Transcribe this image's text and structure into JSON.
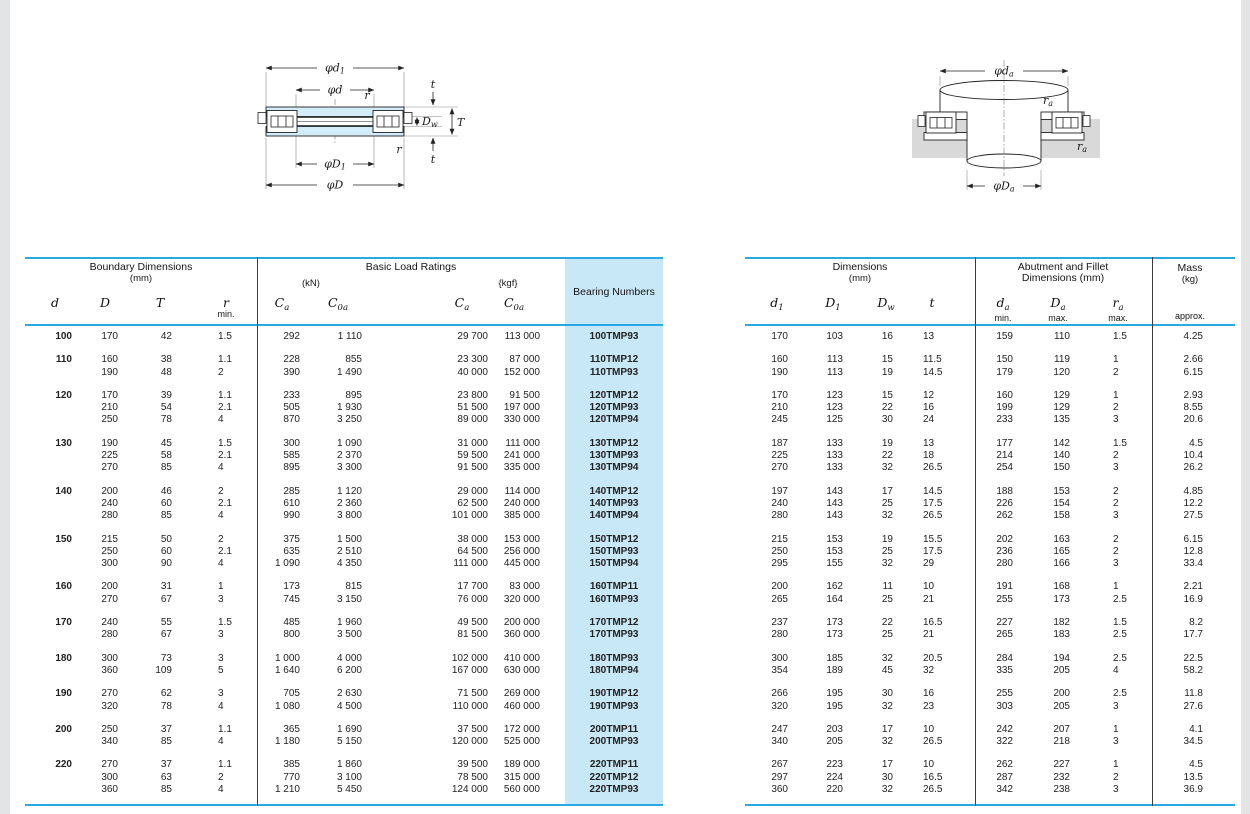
{
  "accent_colors": {
    "rule_cyan": "#29a9e1",
    "shade_blue": "#c9e8f7",
    "washer_blue": "#d3ecfa",
    "housing_gray": "#d9d9d9"
  },
  "diagram_left": {
    "labels": {
      "d1": {
        "main": "φd",
        "sub": "1"
      },
      "d": {
        "main": "φd",
        "sub": ""
      },
      "r_top": {
        "main": "r",
        "sub": ""
      },
      "t_top": {
        "main": "t",
        "sub": ""
      },
      "Dw": {
        "main": "D",
        "sub": "w"
      },
      "T": {
        "main": "T",
        "sub": ""
      },
      "r_bot": {
        "main": "r",
        "sub": ""
      },
      "t_bot": {
        "main": "t",
        "sub": ""
      },
      "D1": {
        "main": "φD",
        "sub": "1"
      },
      "D": {
        "main": "φD",
        "sub": ""
      }
    }
  },
  "diagram_right": {
    "labels": {
      "da": {
        "main": "φd",
        "sub": "a"
      },
      "ra_top": {
        "main": "r",
        "sub": "a"
      },
      "ra_bot": {
        "main": "r",
        "sub": "a"
      },
      "Da": {
        "main": "φD",
        "sub": "a"
      }
    }
  },
  "left_table": {
    "group_header": {
      "boundary": "Boundary Dimensions",
      "boundary_unit": "(mm)",
      "load": "Basic Load Ratings",
      "kn": "(kN)",
      "kgf": "{kgf}",
      "bearing": "Bearing Numbers"
    },
    "symbols": {
      "d": {
        "main": "d",
        "sub": ""
      },
      "D": {
        "main": "D",
        "sub": ""
      },
      "T": {
        "main": "T",
        "sub": ""
      },
      "r": {
        "main": "r",
        "sub": "",
        "note": "min."
      },
      "Ca_kn": {
        "main": "C",
        "sub": "a"
      },
      "C0a_kn": {
        "main": "C",
        "sub": "0a"
      },
      "Ca_kgf": {
        "main": "C",
        "sub": "a"
      },
      "C0a_kgf": {
        "main": "C",
        "sub": "0a"
      }
    },
    "groups": [
      [
        [
          "100",
          "170",
          "42",
          "1.5",
          "292",
          "1 110",
          "29 700",
          "113 000",
          "100TMP93"
        ]
      ],
      [
        [
          "110",
          "160",
          "38",
          "1.1",
          "228",
          "855",
          "23 300",
          "87 000",
          "110TMP12"
        ],
        [
          "",
          "190",
          "48",
          "2",
          "390",
          "1 490",
          "40 000",
          "152 000",
          "110TMP93"
        ]
      ],
      [
        [
          "120",
          "170",
          "39",
          "1.1",
          "233",
          "895",
          "23 800",
          "91 500",
          "120TMP12"
        ],
        [
          "",
          "210",
          "54",
          "2.1",
          "505",
          "1 930",
          "51 500",
          "197 000",
          "120TMP93"
        ],
        [
          "",
          "250",
          "78",
          "4",
          "870",
          "3 250",
          "89 000",
          "330 000",
          "120TMP94"
        ]
      ],
      [
        [
          "130",
          "190",
          "45",
          "1.5",
          "300",
          "1 090",
          "31 000",
          "111 000",
          "130TMP12"
        ],
        [
          "",
          "225",
          "58",
          "2.1",
          "585",
          "2 370",
          "59 500",
          "241 000",
          "130TMP93"
        ],
        [
          "",
          "270",
          "85",
          "4",
          "895",
          "3 300",
          "91 500",
          "335 000",
          "130TMP94"
        ]
      ],
      [
        [
          "140",
          "200",
          "46",
          "2",
          "285",
          "1 120",
          "29 000",
          "114 000",
          "140TMP12"
        ],
        [
          "",
          "240",
          "60",
          "2.1",
          "610",
          "2 360",
          "62 500",
          "240 000",
          "140TMP93"
        ],
        [
          "",
          "280",
          "85",
          "4",
          "990",
          "3 800",
          "101 000",
          "385 000",
          "140TMP94"
        ]
      ],
      [
        [
          "150",
          "215",
          "50",
          "2",
          "375",
          "1 500",
          "38 000",
          "153 000",
          "150TMP12"
        ],
        [
          "",
          "250",
          "60",
          "2.1",
          "635",
          "2 510",
          "64 500",
          "256 000",
          "150TMP93"
        ],
        [
          "",
          "300",
          "90",
          "4",
          "1 090",
          "4 350",
          "111 000",
          "445 000",
          "150TMP94"
        ]
      ],
      [
        [
          "160",
          "200",
          "31",
          "1",
          "173",
          "815",
          "17 700",
          "83 000",
          "160TMP11"
        ],
        [
          "",
          "270",
          "67",
          "3",
          "745",
          "3 150",
          "76 000",
          "320 000",
          "160TMP93"
        ]
      ],
      [
        [
          "170",
          "240",
          "55",
          "1.5",
          "485",
          "1 960",
          "49 500",
          "200 000",
          "170TMP12"
        ],
        [
          "",
          "280",
          "67",
          "3",
          "800",
          "3 500",
          "81 500",
          "360 000",
          "170TMP93"
        ]
      ],
      [
        [
          "180",
          "300",
          "73",
          "3",
          "1 000",
          "4 000",
          "102 000",
          "410 000",
          "180TMP93"
        ],
        [
          "",
          "360",
          "109",
          "5",
          "1 640",
          "6 200",
          "167 000",
          "630 000",
          "180TMP94"
        ]
      ],
      [
        [
          "190",
          "270",
          "62",
          "3",
          "705",
          "2 630",
          "71 500",
          "269 000",
          "190TMP12"
        ],
        [
          "",
          "320",
          "78",
          "4",
          "1 080",
          "4 500",
          "110 000",
          "460 000",
          "190TMP93"
        ]
      ],
      [
        [
          "200",
          "250",
          "37",
          "1.1",
          "365",
          "1 690",
          "37 500",
          "172 000",
          "200TMP11"
        ],
        [
          "",
          "340",
          "85",
          "4",
          "1 180",
          "5 150",
          "120 000",
          "525 000",
          "200TMP93"
        ]
      ],
      [
        [
          "220",
          "270",
          "37",
          "1.1",
          "385",
          "1 860",
          "39 500",
          "189 000",
          "220TMP11"
        ],
        [
          "",
          "300",
          "63",
          "2",
          "770",
          "3 100",
          "78 500",
          "315 000",
          "220TMP12"
        ],
        [
          "",
          "360",
          "85",
          "4",
          "1 210",
          "5 450",
          "124 000",
          "560 000",
          "220TMP93"
        ]
      ]
    ]
  },
  "right_table": {
    "group_header": {
      "dims": "Dimensions",
      "dims_unit": "(mm)",
      "abutment_line1": "Abutment and Fillet",
      "abutment_line2": "Dimensions (mm)",
      "mass": "Mass",
      "mass_unit": "(kg)",
      "approx": "approx."
    },
    "symbols": {
      "d1": {
        "main": "d",
        "sub": "1",
        "note": ""
      },
      "D1": {
        "main": "D",
        "sub": "1",
        "note": ""
      },
      "Dw": {
        "main": "D",
        "sub": "w",
        "note": ""
      },
      "t": {
        "main": "t",
        "sub": "",
        "note": ""
      },
      "da": {
        "main": "d",
        "sub": "a",
        "note": "min."
      },
      "Da": {
        "main": "D",
        "sub": "a",
        "note": "max."
      },
      "ra": {
        "main": "r",
        "sub": "a",
        "note": "max."
      }
    },
    "groups": [
      [
        [
          "170",
          "103",
          "16",
          "13",
          "159",
          "110",
          "1.5",
          "4.25"
        ]
      ],
      [
        [
          "160",
          "113",
          "15",
          "11.5",
          "150",
          "119",
          "1",
          "2.66"
        ],
        [
          "190",
          "113",
          "19",
          "14.5",
          "179",
          "120",
          "2",
          "6.15"
        ]
      ],
      [
        [
          "170",
          "123",
          "15",
          "12",
          "160",
          "129",
          "1",
          "2.93"
        ],
        [
          "210",
          "123",
          "22",
          "16",
          "199",
          "129",
          "2",
          "8.55"
        ],
        [
          "245",
          "125",
          "30",
          "24",
          "233",
          "135",
          "3",
          "20.6"
        ]
      ],
      [
        [
          "187",
          "133",
          "19",
          "13",
          "177",
          "142",
          "1.5",
          "4.5"
        ],
        [
          "225",
          "133",
          "22",
          "18",
          "214",
          "140",
          "2",
          "10.4"
        ],
        [
          "270",
          "133",
          "32",
          "26.5",
          "254",
          "150",
          "3",
          "26.2"
        ]
      ],
      [
        [
          "197",
          "143",
          "17",
          "14.5",
          "188",
          "153",
          "2",
          "4.85"
        ],
        [
          "240",
          "143",
          "25",
          "17.5",
          "226",
          "154",
          "2",
          "12.2"
        ],
        [
          "280",
          "143",
          "32",
          "26.5",
          "262",
          "158",
          "3",
          "27.5"
        ]
      ],
      [
        [
          "215",
          "153",
          "19",
          "15.5",
          "202",
          "163",
          "2",
          "6.15"
        ],
        [
          "250",
          "153",
          "25",
          "17.5",
          "236",
          "165",
          "2",
          "12.8"
        ],
        [
          "295",
          "155",
          "32",
          "29",
          "280",
          "166",
          "3",
          "33.4"
        ]
      ],
      [
        [
          "200",
          "162",
          "11",
          "10",
          "191",
          "168",
          "1",
          "2.21"
        ],
        [
          "265",
          "164",
          "25",
          "21",
          "255",
          "173",
          "2.5",
          "16.9"
        ]
      ],
      [
        [
          "237",
          "173",
          "22",
          "16.5",
          "227",
          "182",
          "1.5",
          "8.2"
        ],
        [
          "280",
          "173",
          "25",
          "21",
          "265",
          "183",
          "2.5",
          "17.7"
        ]
      ],
      [
        [
          "300",
          "185",
          "32",
          "20.5",
          "284",
          "194",
          "2.5",
          "22.5"
        ],
        [
          "354",
          "189",
          "45",
          "32",
          "335",
          "205",
          "4",
          "58.2"
        ]
      ],
      [
        [
          "266",
          "195",
          "30",
          "16",
          "255",
          "200",
          "2.5",
          "11.8"
        ],
        [
          "320",
          "195",
          "32",
          "23",
          "303",
          "205",
          "3",
          "27.6"
        ]
      ],
      [
        [
          "247",
          "203",
          "17",
          "10",
          "242",
          "207",
          "1",
          "4.1"
        ],
        [
          "340",
          "205",
          "32",
          "26.5",
          "322",
          "218",
          "3",
          "34.5"
        ]
      ],
      [
        [
          "267",
          "223",
          "17",
          "10",
          "262",
          "227",
          "1",
          "4.5"
        ],
        [
          "297",
          "224",
          "30",
          "16.5",
          "287",
          "232",
          "2",
          "13.5"
        ],
        [
          "360",
          "220",
          "32",
          "26.5",
          "342",
          "238",
          "3",
          "36.9"
        ]
      ]
    ]
  }
}
